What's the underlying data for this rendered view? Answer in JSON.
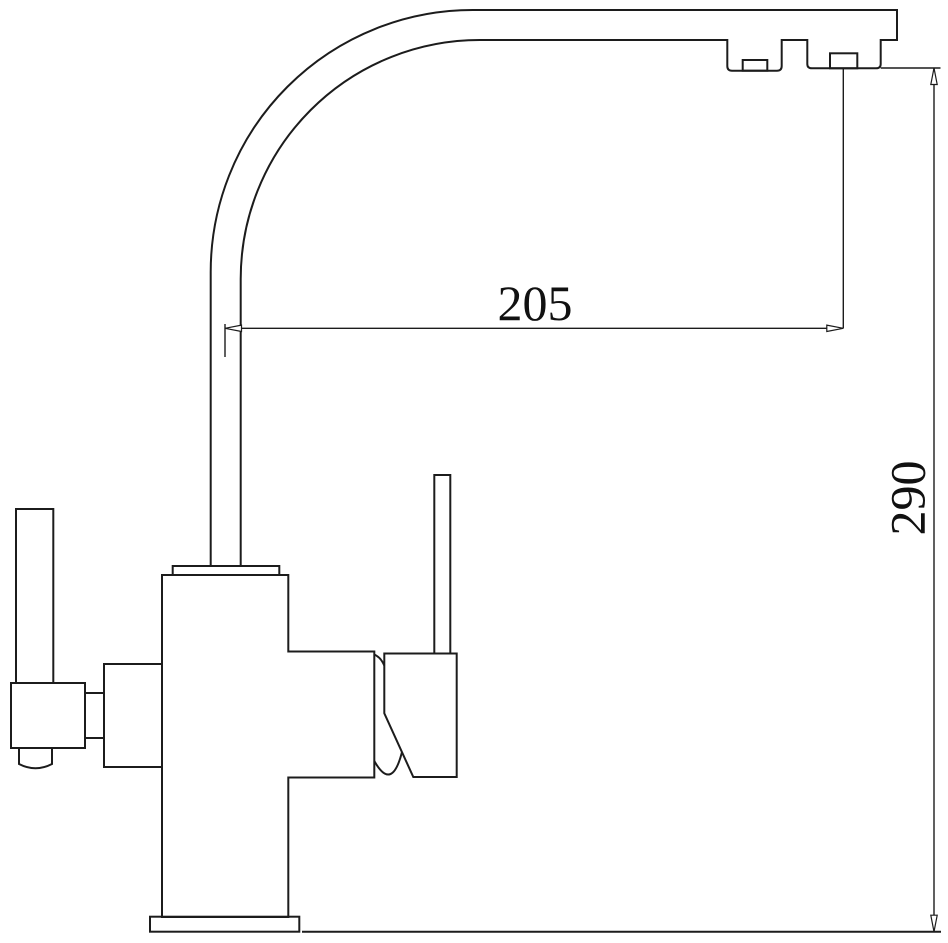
{
  "diagram": {
    "dimensions": {
      "horizontal": "205",
      "vertical": "290"
    },
    "colors": {
      "line": "#1c1c1c",
      "background": "#ffffff",
      "text": "#111111"
    }
  }
}
